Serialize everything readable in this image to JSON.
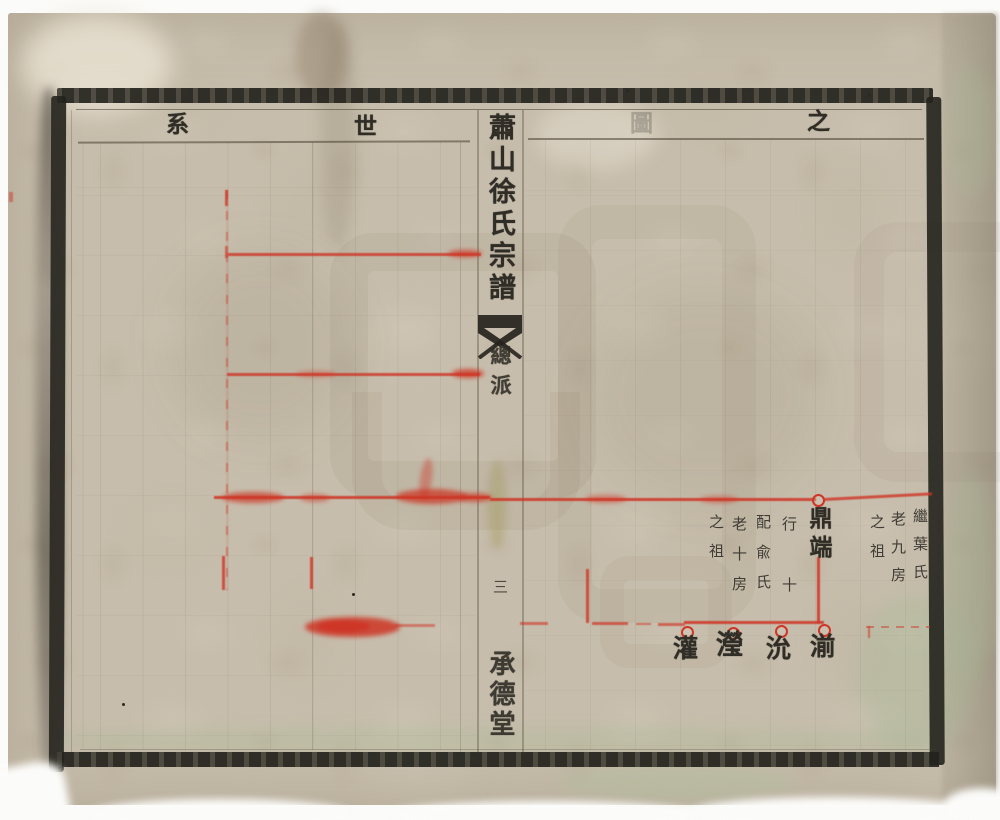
{
  "page": {
    "header": {
      "chars": [
        "系",
        "世",
        "圖",
        "之"
      ]
    },
    "spine": {
      "title": "蕭山徐氏宗譜",
      "section": "總派",
      "page_number": "三",
      "hall_name": "承德堂"
    },
    "chart": {
      "node": {
        "name": "鼎端",
        "annotation_text": "行十配兪氏老十房之祖",
        "annotation_columns": [
          "行十",
          "配兪氏",
          "老十房",
          "之祖"
        ]
      },
      "right_annotation_text": "繼葉氏老九房之祖",
      "right_annotation_columns": [
        "繼葉氏",
        "老九房",
        "之祖"
      ],
      "children": [
        "湔",
        "沇",
        "瀅",
        "灌"
      ]
    },
    "colors": {
      "paper": "#c7bdac",
      "ink": "#2f2d26",
      "red_ink": "#cf3526"
    }
  }
}
